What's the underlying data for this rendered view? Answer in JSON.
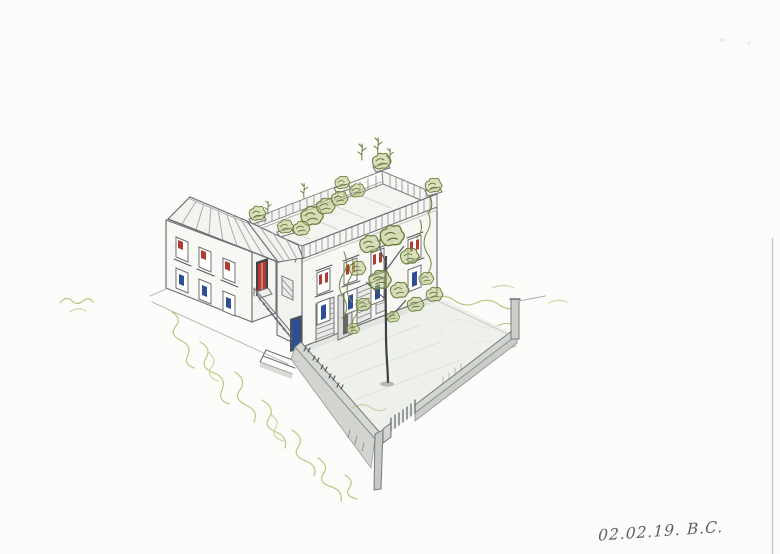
{
  "annotation": {
    "date_signature": "02.02.19. B.C."
  },
  "palette": {
    "paper": "#fcfcfa",
    "pencil": "#6d7175",
    "pencil_dark": "#45484c",
    "wall_gray": "#d3d5d1",
    "courtyard_gray": "#eceee9",
    "plant_green_dark": "#6c8040",
    "plant_green_fill": "#b9c47e",
    "ground_green": "#b3bd6e",
    "window_accent_red": "#b23a2e",
    "window_accent_blue": "#2e4e94"
  },
  "sketch": {
    "subject": "Hand-drawn isometric pencil sketch of an L-shaped two-storey house with a pitched-roof wing, a flat roof terrace full of potted plants, an external staircase, red and blue window accents, and a walled courtyard with a gate and a small tree",
    "elements": [
      "left-wing",
      "main-block",
      "roof-terrace",
      "external-staircase",
      "courtyard",
      "garden-walls",
      "courtyard-gate",
      "tree",
      "ground-vegetation",
      "date-signature"
    ]
  }
}
